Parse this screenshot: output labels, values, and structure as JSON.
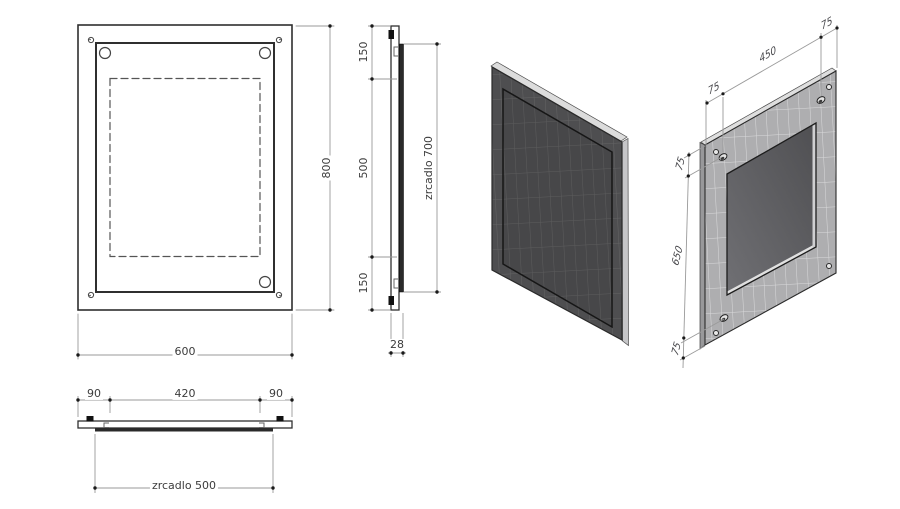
{
  "drawing": {
    "title": "mirror technical drawing",
    "front_view": {
      "dim_width": "600",
      "dim_height": "800"
    },
    "side_view": {
      "dim_top": "150",
      "dim_middle": "500",
      "dim_bottom": "150",
      "dim_glass_height": "zrcadlo 700",
      "dim_thickness": "28"
    },
    "bottom_view": {
      "dim_left": "90",
      "dim_center": "420",
      "dim_right": "90",
      "dim_glass_width": "zrcadlo 500"
    },
    "iso_back_view": {
      "dim_hole_span_width": "450",
      "dim_top_left_offset": "75",
      "dim_top_right_offset": "75",
      "dim_left_top_offset": "75",
      "dim_hole_span_height": "650",
      "dim_left_bottom_offset": "75"
    },
    "colors": {
      "background": "#ffffff",
      "line": "#2f2f2f",
      "dim_line": "#9a9a9a",
      "dim_text": "#3c3c3c",
      "mirror_face": "#4e4e50",
      "panel_back_face": "#aeaeb0",
      "recess_face": "#59595c",
      "edge_highlight": "#dcdcdc"
    }
  }
}
